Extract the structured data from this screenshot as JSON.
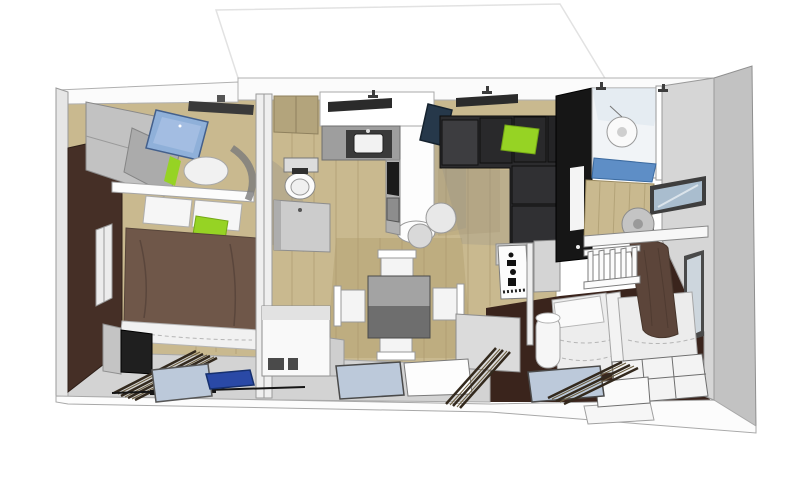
{
  "scene": {
    "type": "3d-floorplan-aerial-cutaway",
    "rooms": [
      "master-bedroom",
      "wc",
      "kitchen",
      "dining-living",
      "shower-room",
      "kids-bedroom"
    ],
    "furniture": [
      "double-bed",
      "overhead-cabinets",
      "toilet",
      "vanity",
      "kitchen-counter",
      "sink",
      "stove",
      "bar-stools",
      "dining-table",
      "dining-chairs",
      "corner-sofa",
      "tv-wall",
      "shower",
      "ceiling-fan",
      "bunk-shelf",
      "twin-beds",
      "step-drawers",
      "wardrobe",
      "deco-panel"
    ]
  },
  "palette": {
    "background": "#ffffff",
    "ceiling": "#fbfbfb",
    "wallGray": "#d6d6d6",
    "wallGrayDark": "#c2c2c2",
    "band": "#d3d3d3",
    "wood": "#c9b98f",
    "woodLine": "#ab9a6f",
    "woodShade": "#b4a172",
    "brownWall": "#452f26",
    "brownFloor": "#3a241c",
    "duvet": "#6f5749",
    "blanket": "#5c453a",
    "green": "#96d324",
    "skyWindow": "#8fb0d9",
    "glass": "#bcc9da",
    "showerFloor": "#5e8ec6",
    "navy": "#26384a",
    "mat": "#2a49a6",
    "sofa": "#2c2c2e",
    "sofaLight": "#3d3d40",
    "blackWall": "#161616",
    "tan": "#b3a47c",
    "counter": "#9e9e9e",
    "sinkDark": "#3a3a3a",
    "appliance": "#1b1b1b",
    "fan": "#c4c4c4",
    "tableTop": "#a3a3a3",
    "tableSide": "#6e6e6e",
    "pane": "#a9bdce"
  }
}
